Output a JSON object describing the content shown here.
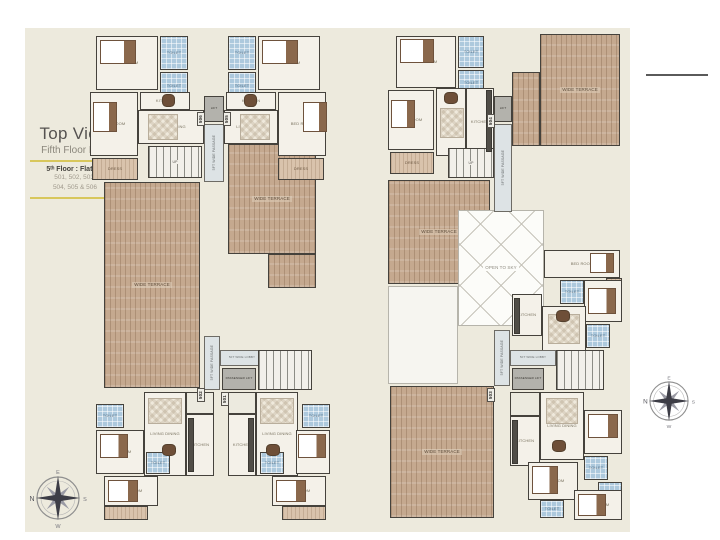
{
  "page": {
    "title": "Top View",
    "subtitle": "Fifth Floor Plan",
    "floor_label": "5ᵗʰ Floor : Flat No",
    "flats_line1": "501, 502, 503,",
    "flats_line2": "504, 505 & 506"
  },
  "compass": {
    "n": "N",
    "e": "E",
    "s": "S",
    "w": "W"
  },
  "accent_colors": {
    "sheet_beige": "#edeadd",
    "rule_yellow": "#d8c75c",
    "wall_dark": "#45423c",
    "bath_blue": "#adc9dd",
    "wood_tan": "#c5a98f"
  },
  "plans": [
    {
      "id": "left-floor-plan",
      "rooms": [
        {
          "t": "wood",
          "l": "WIDE TERRACE",
          "x": 104,
          "y": 182,
          "w": 96,
          "h": 206
        },
        {
          "t": "wood",
          "l": "WIDE TERRACE",
          "x": 228,
          "y": 144,
          "w": 88,
          "h": 110
        },
        {
          "t": "wood",
          "l": "",
          "x": 268,
          "y": 254,
          "w": 48,
          "h": 34
        },
        {
          "t": "room",
          "l": "BED ROOM",
          "x": 96,
          "y": 36,
          "w": 62,
          "h": 54
        },
        {
          "t": "bath",
          "l": "TOILET",
          "x": 160,
          "y": 36,
          "w": 28,
          "h": 34
        },
        {
          "t": "bath",
          "l": "TOILET",
          "x": 160,
          "y": 72,
          "w": 28,
          "h": 28
        },
        {
          "t": "room",
          "l": "BED ROOM",
          "x": 90,
          "y": 92,
          "w": 48,
          "h": 64
        },
        {
          "t": "woodlite",
          "l": "DRESS",
          "x": 92,
          "y": 158,
          "w": 46,
          "h": 22
        },
        {
          "t": "room",
          "l": "KITCHEN",
          "x": 140,
          "y": 92,
          "w": 50,
          "h": 18
        },
        {
          "t": "room",
          "l": "LIVING DINING",
          "x": 138,
          "y": 110,
          "w": 66,
          "h": 34
        },
        {
          "t": "room",
          "l": "BED ROOM",
          "x": 258,
          "y": 36,
          "w": 62,
          "h": 54
        },
        {
          "t": "bath",
          "l": "TOILET",
          "x": 228,
          "y": 36,
          "w": 28,
          "h": 34
        },
        {
          "t": "bath",
          "l": "TOILET",
          "x": 228,
          "y": 72,
          "w": 28,
          "h": 28
        },
        {
          "t": "room",
          "l": "BED ROOM",
          "x": 278,
          "y": 92,
          "w": 48,
          "h": 64
        },
        {
          "t": "woodlite",
          "l": "DRESS",
          "x": 278,
          "y": 158,
          "w": 46,
          "h": 22
        },
        {
          "t": "room",
          "l": "KITCHEN",
          "x": 226,
          "y": 92,
          "w": 50,
          "h": 18
        },
        {
          "t": "room",
          "l": "LIVING DINING",
          "x": 224,
          "y": 110,
          "w": 54,
          "h": 34
        },
        {
          "t": "stair",
          "l": "UP",
          "x": 148,
          "y": 146,
          "w": 54,
          "h": 32
        },
        {
          "t": "lift",
          "l": "LIFT",
          "x": 204,
          "y": 96,
          "w": 20,
          "h": 26
        },
        {
          "t": "corr",
          "l": "5FT WIDE PASSAGE",
          "v": 1,
          "x": 204,
          "y": 124,
          "w": 20,
          "h": 58
        },
        {
          "t": "corr",
          "l": "5FT WIDE PASSAGE",
          "v": 1,
          "x": 204,
          "y": 336,
          "w": 16,
          "h": 54
        },
        {
          "t": "corr",
          "l": "5FT WIDE LOBBY",
          "x": 220,
          "y": 350,
          "w": 44,
          "h": 16,
          "fs": 3
        },
        {
          "t": "lift",
          "l": "PASSENGER LIFT",
          "x": 222,
          "y": 368,
          "w": 34,
          "h": 22
        },
        {
          "t": "stair",
          "l": "",
          "x": 258,
          "y": 350,
          "w": 54,
          "h": 40
        },
        {
          "t": "room",
          "l": "LIVING DINING",
          "x": 144,
          "y": 392,
          "w": 42,
          "h": 84
        },
        {
          "t": "room",
          "l": "LIVING DINING",
          "x": 256,
          "y": 392,
          "w": 42,
          "h": 84
        },
        {
          "t": "room",
          "l": "KITCHEN",
          "x": 186,
          "y": 414,
          "w": 28,
          "h": 62
        },
        {
          "t": "room",
          "l": "KITCHEN",
          "x": 228,
          "y": 414,
          "w": 28,
          "h": 62
        },
        {
          "t": "room2",
          "l": "",
          "x": 186,
          "y": 392,
          "w": 28,
          "h": 22
        },
        {
          "t": "room2",
          "l": "",
          "x": 228,
          "y": 392,
          "w": 28,
          "h": 22
        },
        {
          "t": "room",
          "l": "BED ROOM",
          "x": 96,
          "y": 430,
          "w": 48,
          "h": 44
        },
        {
          "t": "bath",
          "l": "TOILET",
          "x": 96,
          "y": 404,
          "w": 28,
          "h": 24
        },
        {
          "t": "room",
          "l": "BED ROOM",
          "x": 104,
          "y": 476,
          "w": 54,
          "h": 30
        },
        {
          "t": "bath",
          "l": "TOILET",
          "x": 146,
          "y": 452,
          "w": 24,
          "h": 22
        },
        {
          "t": "room",
          "l": "BED ROOM",
          "x": 296,
          "y": 430,
          "w": 34,
          "h": 44
        },
        {
          "t": "bath",
          "l": "TOILET",
          "x": 302,
          "y": 404,
          "w": 28,
          "h": 24
        },
        {
          "t": "room",
          "l": "BED ROOM",
          "x": 272,
          "y": 476,
          "w": 54,
          "h": 30
        },
        {
          "t": "bath",
          "l": "TOILET",
          "x": 260,
          "y": 452,
          "w": 24,
          "h": 22
        },
        {
          "t": "woodlite",
          "l": "",
          "x": 104,
          "y": 506,
          "w": 44,
          "h": 14
        },
        {
          "t": "woodlite",
          "l": "",
          "x": 282,
          "y": 506,
          "w": 44,
          "h": 14
        },
        {
          "t": "bed",
          "x": 100,
          "y": 40,
          "w": 36,
          "h": 24
        },
        {
          "t": "bed",
          "x": 262,
          "y": 40,
          "w": 36,
          "h": 24
        },
        {
          "t": "bed",
          "x": 93,
          "y": 102,
          "w": 24,
          "h": 30
        },
        {
          "t": "bed",
          "x": 303,
          "y": 102,
          "w": 24,
          "h": 30
        },
        {
          "t": "table",
          "x": 162,
          "y": 94,
          "w": 13,
          "h": 13
        },
        {
          "t": "table",
          "x": 244,
          "y": 94,
          "w": 13,
          "h": 13
        },
        {
          "t": "rug",
          "x": 148,
          "y": 114,
          "w": 30,
          "h": 26
        },
        {
          "t": "rug",
          "x": 240,
          "y": 114,
          "w": 30,
          "h": 26
        },
        {
          "t": "counter",
          "x": 188,
          "y": 418,
          "w": 6,
          "h": 54
        },
        {
          "t": "counter",
          "x": 248,
          "y": 418,
          "w": 6,
          "h": 54
        },
        {
          "t": "table",
          "x": 162,
          "y": 444,
          "w": 14,
          "h": 12
        },
        {
          "t": "table",
          "x": 266,
          "y": 444,
          "w": 14,
          "h": 12
        },
        {
          "t": "rug",
          "x": 148,
          "y": 398,
          "w": 34,
          "h": 26
        },
        {
          "t": "rug",
          "x": 260,
          "y": 398,
          "w": 34,
          "h": 26
        },
        {
          "t": "bed",
          "x": 100,
          "y": 434,
          "w": 28,
          "h": 24
        },
        {
          "t": "bed",
          "x": 298,
          "y": 434,
          "w": 28,
          "h": 24
        },
        {
          "t": "bed",
          "x": 108,
          "y": 480,
          "w": 30,
          "h": 22
        },
        {
          "t": "bed",
          "x": 276,
          "y": 480,
          "w": 30,
          "h": 22
        },
        {
          "t": "badge",
          "l": "506",
          "v": 1,
          "x": 197,
          "y": 112,
          "w": 8,
          "h": 14
        },
        {
          "t": "badge",
          "l": "505",
          "v": 1,
          "x": 223,
          "y": 112,
          "w": 8,
          "h": 14
        },
        {
          "t": "badge",
          "l": "502",
          "v": 1,
          "x": 197,
          "y": 388,
          "w": 8,
          "h": 14
        },
        {
          "t": "badge",
          "l": "501",
          "v": 1,
          "x": 221,
          "y": 392,
          "w": 8,
          "h": 14
        }
      ]
    },
    {
      "id": "right-floor-plan",
      "rooms": [
        {
          "t": "wood",
          "l": "WIDE TERRACE",
          "x": 540,
          "y": 34,
          "w": 80,
          "h": 112
        },
        {
          "t": "wood",
          "l": "",
          "x": 512,
          "y": 72,
          "w": 28,
          "h": 74
        },
        {
          "t": "wood",
          "l": "WIDE TERRACE",
          "x": 388,
          "y": 180,
          "w": 102,
          "h": 104
        },
        {
          "t": "wood",
          "l": "WIDE TERRACE",
          "x": 390,
          "y": 386,
          "w": 104,
          "h": 132
        },
        {
          "t": "white",
          "l": "",
          "x": 388,
          "y": 286,
          "w": 70,
          "h": 98
        },
        {
          "t": "open",
          "l": "OPEN TO SKY",
          "x": 458,
          "y": 210,
          "w": 86,
          "h": 116
        },
        {
          "t": "room",
          "l": "BED ROOM",
          "x": 396,
          "y": 36,
          "w": 60,
          "h": 52
        },
        {
          "t": "bath",
          "l": "TOILET",
          "x": 458,
          "y": 36,
          "w": 26,
          "h": 32
        },
        {
          "t": "bath",
          "l": "TOILET",
          "x": 458,
          "y": 70,
          "w": 26,
          "h": 26
        },
        {
          "t": "room",
          "l": "BED ROOM",
          "x": 388,
          "y": 90,
          "w": 46,
          "h": 60
        },
        {
          "t": "woodlite",
          "l": "DRESS",
          "x": 390,
          "y": 152,
          "w": 44,
          "h": 22
        },
        {
          "t": "room",
          "l": "LIVING DINING",
          "x": 436,
          "y": 88,
          "w": 30,
          "h": 68
        },
        {
          "t": "room",
          "l": "KITCHEN",
          "x": 466,
          "y": 88,
          "w": 28,
          "h": 68
        },
        {
          "t": "lift",
          "l": "LIFT",
          "x": 494,
          "y": 96,
          "w": 18,
          "h": 26
        },
        {
          "t": "corr",
          "l": "5FT WIDE PASSAGE",
          "v": 1,
          "x": 494,
          "y": 124,
          "w": 18,
          "h": 88
        },
        {
          "t": "stair",
          "l": "UP",
          "x": 448,
          "y": 148,
          "w": 46,
          "h": 30
        },
        {
          "t": "room",
          "l": "BED ROOM",
          "x": 544,
          "y": 250,
          "w": 76,
          "h": 28
        },
        {
          "t": "woodlite",
          "l": "",
          "x": 606,
          "y": 278,
          "w": 16,
          "h": 44
        },
        {
          "t": "room",
          "l": "BED ROOM",
          "x": 584,
          "y": 280,
          "w": 38,
          "h": 42
        },
        {
          "t": "bath",
          "l": "TOILET",
          "x": 560,
          "y": 280,
          "w": 24,
          "h": 24
        },
        {
          "t": "room",
          "l": "KITCHEN",
          "x": 512,
          "y": 294,
          "w": 30,
          "h": 42
        },
        {
          "t": "room",
          "l": "LIVING DINING",
          "x": 542,
          "y": 306,
          "w": 44,
          "h": 46
        },
        {
          "t": "bath",
          "l": "TOILET",
          "x": 586,
          "y": 324,
          "w": 24,
          "h": 24
        },
        {
          "t": "corr",
          "l": "5FT WIDE PASSAGE",
          "v": 1,
          "x": 494,
          "y": 330,
          "w": 16,
          "h": 56
        },
        {
          "t": "corr",
          "l": "5FT WIDE LOBBY",
          "x": 510,
          "y": 350,
          "w": 46,
          "h": 16,
          "fs": 3
        },
        {
          "t": "lift",
          "l": "PASSENGER LIFT",
          "x": 512,
          "y": 368,
          "w": 32,
          "h": 22
        },
        {
          "t": "stair",
          "l": "",
          "x": 556,
          "y": 350,
          "w": 48,
          "h": 40
        },
        {
          "t": "room",
          "l": "LIVING DINING",
          "x": 540,
          "y": 392,
          "w": 44,
          "h": 68
        },
        {
          "t": "room",
          "l": "KITCHEN",
          "x": 510,
          "y": 416,
          "w": 30,
          "h": 50
        },
        {
          "t": "room2",
          "l": "",
          "x": 510,
          "y": 392,
          "w": 30,
          "h": 24
        },
        {
          "t": "room",
          "l": "BED ROOM",
          "x": 584,
          "y": 410,
          "w": 38,
          "h": 44
        },
        {
          "t": "bath",
          "l": "TOILET",
          "x": 584,
          "y": 456,
          "w": 24,
          "h": 24
        },
        {
          "t": "bath",
          "l": "TOILET",
          "x": 598,
          "y": 482,
          "w": 24,
          "h": 20
        },
        {
          "t": "room",
          "l": "BED ROOM",
          "x": 528,
          "y": 462,
          "w": 50,
          "h": 38
        },
        {
          "t": "bath",
          "l": "TOILET",
          "x": 540,
          "y": 500,
          "w": 24,
          "h": 18
        },
        {
          "t": "room",
          "l": "BED ROOM",
          "x": 574,
          "y": 490,
          "w": 48,
          "h": 30
        },
        {
          "t": "bed",
          "x": 400,
          "y": 39,
          "w": 34,
          "h": 24
        },
        {
          "t": "bed",
          "x": 391,
          "y": 100,
          "w": 24,
          "h": 28
        },
        {
          "t": "table",
          "x": 444,
          "y": 92,
          "w": 14,
          "h": 12
        },
        {
          "t": "rug",
          "x": 440,
          "y": 108,
          "w": 24,
          "h": 30
        },
        {
          "t": "counter",
          "x": 486,
          "y": 90,
          "w": 6,
          "h": 62
        },
        {
          "t": "bed",
          "x": 590,
          "y": 253,
          "w": 24,
          "h": 20
        },
        {
          "t": "bed",
          "x": 588,
          "y": 288,
          "w": 28,
          "h": 26
        },
        {
          "t": "rug",
          "x": 548,
          "y": 314,
          "w": 32,
          "h": 30
        },
        {
          "t": "table",
          "x": 556,
          "y": 310,
          "w": 14,
          "h": 12
        },
        {
          "t": "counter",
          "x": 514,
          "y": 298,
          "w": 6,
          "h": 36
        },
        {
          "t": "rug",
          "x": 546,
          "y": 398,
          "w": 32,
          "h": 26
        },
        {
          "t": "table",
          "x": 552,
          "y": 440,
          "w": 14,
          "h": 12
        },
        {
          "t": "counter",
          "x": 512,
          "y": 420,
          "w": 6,
          "h": 44
        },
        {
          "t": "bed",
          "x": 588,
          "y": 414,
          "w": 30,
          "h": 24
        },
        {
          "t": "bed",
          "x": 532,
          "y": 466,
          "w": 26,
          "h": 28
        },
        {
          "t": "bed",
          "x": 578,
          "y": 494,
          "w": 28,
          "h": 22
        },
        {
          "t": "badge",
          "l": "504",
          "v": 1,
          "x": 487,
          "y": 114,
          "w": 8,
          "h": 14
        },
        {
          "t": "badge",
          "l": "503",
          "v": 1,
          "x": 487,
          "y": 388,
          "w": 8,
          "h": 14
        }
      ]
    }
  ]
}
